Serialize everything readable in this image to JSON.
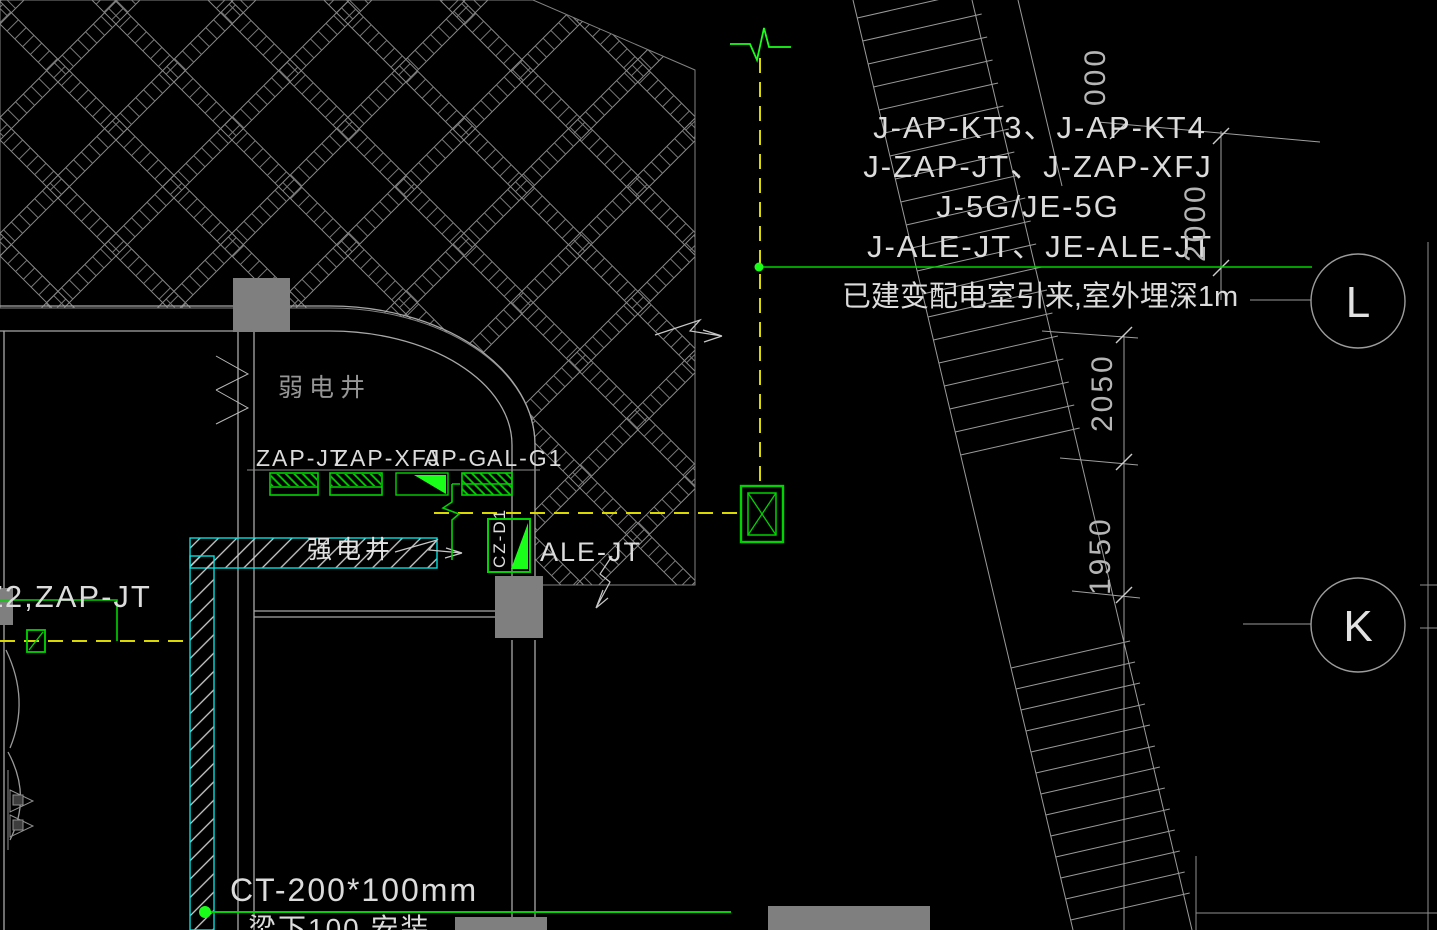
{
  "colors": {
    "background": "#000000",
    "wall_gray": "#a8a8a8",
    "hatch_gray": "#8a8a8a",
    "green": "#00d400",
    "bright_green": "#19ff19",
    "yellow_dash": "#d9d900",
    "cyan": "#00e0e0",
    "column_gray": "#7f7f7f",
    "text_white": "#e2e2e2",
    "text_gray": "#969696"
  },
  "notes": {
    "feeder_line1": "J-AP-KT3、J-AP-KT4",
    "feeder_line2": "J-ZAP-JT、J-ZAP-XFJ",
    "feeder_line3": "J-5G/JE-5G",
    "feeder_line4": "J-ALE-JT、JE-ALE-JT",
    "source_note": "已建变配电室引来,室外埋深1m",
    "cable_tray": "CT-200*100mm",
    "cable_tray_sub": "梁下100  安装",
    "left_circuit": "Z2,ZAP-JT"
  },
  "rooms": {
    "weak_shaft": "弱电井",
    "strong_shaft": "强电井"
  },
  "panels": {
    "labels": [
      "ZAP-JT",
      "ZAP-XFJ",
      "AP-G",
      "AL-G1"
    ],
    "ale": "ALE-JT",
    "cz": "CZ-D1"
  },
  "dimensions": {
    "vertical_2000": "2000",
    "upper_2050": "2050",
    "lower_1950": "1950",
    "top_partial": "000"
  },
  "grid_bubbles": {
    "row_l": "L",
    "row_k": "K"
  }
}
